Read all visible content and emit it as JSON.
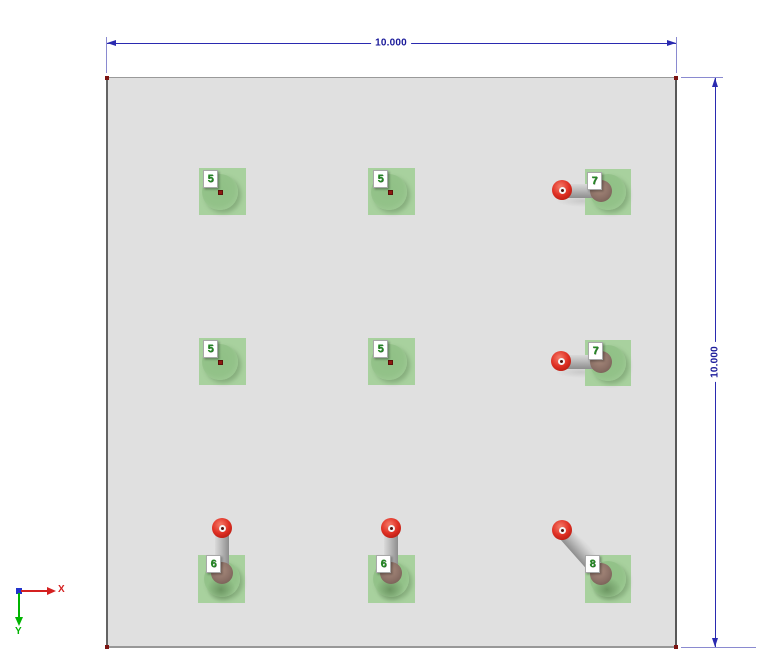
{
  "view": {
    "background": "#ffffff"
  },
  "plate": {
    "fill": "#e0e0e0",
    "edge_color": "#8f8f8f",
    "corner_marker_color": "#7c1412"
  },
  "dimensions": {
    "color": "#2222aa",
    "top": {
      "value": "10.000"
    },
    "right": {
      "value": "10.000"
    }
  },
  "axis_triad": {
    "x_label": "X",
    "x_color": "#d42020",
    "y_label": "Y",
    "y_color": "#00b400",
    "origin_color": "#2233cc"
  },
  "supports": {
    "pad_color": "#a8d19e",
    "sphere_color": "#e03125",
    "joint_color": "#8b7066",
    "link_color": "#bdbdbd",
    "tag_text_color": "#258a25",
    "items": [
      {
        "label": "5"
      },
      {
        "label": "5"
      },
      {
        "label": "7"
      },
      {
        "label": "5"
      },
      {
        "label": "5"
      },
      {
        "label": "7"
      },
      {
        "label": "6"
      },
      {
        "label": "6"
      },
      {
        "label": "8"
      }
    ]
  }
}
